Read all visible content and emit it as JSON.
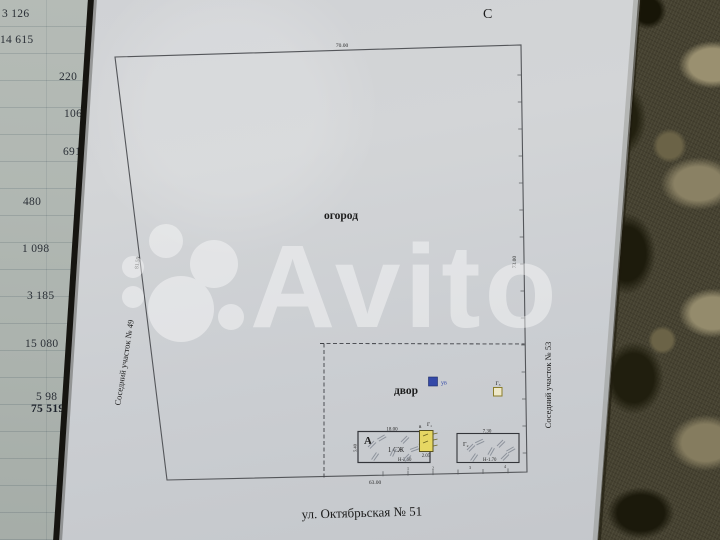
{
  "plan": {
    "north_label": "С",
    "garden_label": "огород",
    "yard_label": "двор",
    "street_label": "ул. Октябрьская №  51",
    "left_neighbor_label": "Соседний участок № 49",
    "right_neighbor_label": "Соседний участок № 53",
    "dim_top": "70.00",
    "dim_bottom": "63.00",
    "dim_left": "81.50",
    "dim_right": "73.00"
  },
  "structures": {
    "house_letter": "А",
    "house_type": "1 СЖ",
    "house_dim_top": "18.00",
    "house_dim_side": "5.40",
    "house_height_mark": "Н-2.60",
    "annex_letter_small": "в",
    "annex_letter": "Г₁",
    "annex_dim": "2.05",
    "shed_letter": "Г₂",
    "shed_dim_top": "7.30",
    "shed_height_mark": "Н-1.70",
    "outbuilding_letter": "Г₃",
    "utility_label": "ув"
  },
  "boundary_points": [
    "1",
    "2",
    "3",
    "4"
  ],
  "ledger_column": {
    "values": [
      "3 126",
      "14 615",
      "220",
      "106",
      "691",
      "480",
      "1 098",
      "3 185",
      "15 080",
      "5 98",
      "75 519"
    ]
  },
  "watermark": {
    "text": "Avito"
  },
  "colors": {
    "paper": "#ced1d4",
    "ledger_paper": "#d6dad7",
    "fabric_dark": "#35321e",
    "fabric_light": "#8f8869",
    "utility_blue": "#3449a8",
    "annex_fill": "#e6d763",
    "ink": "#1c1c1c",
    "watermark": "#ffffff"
  }
}
